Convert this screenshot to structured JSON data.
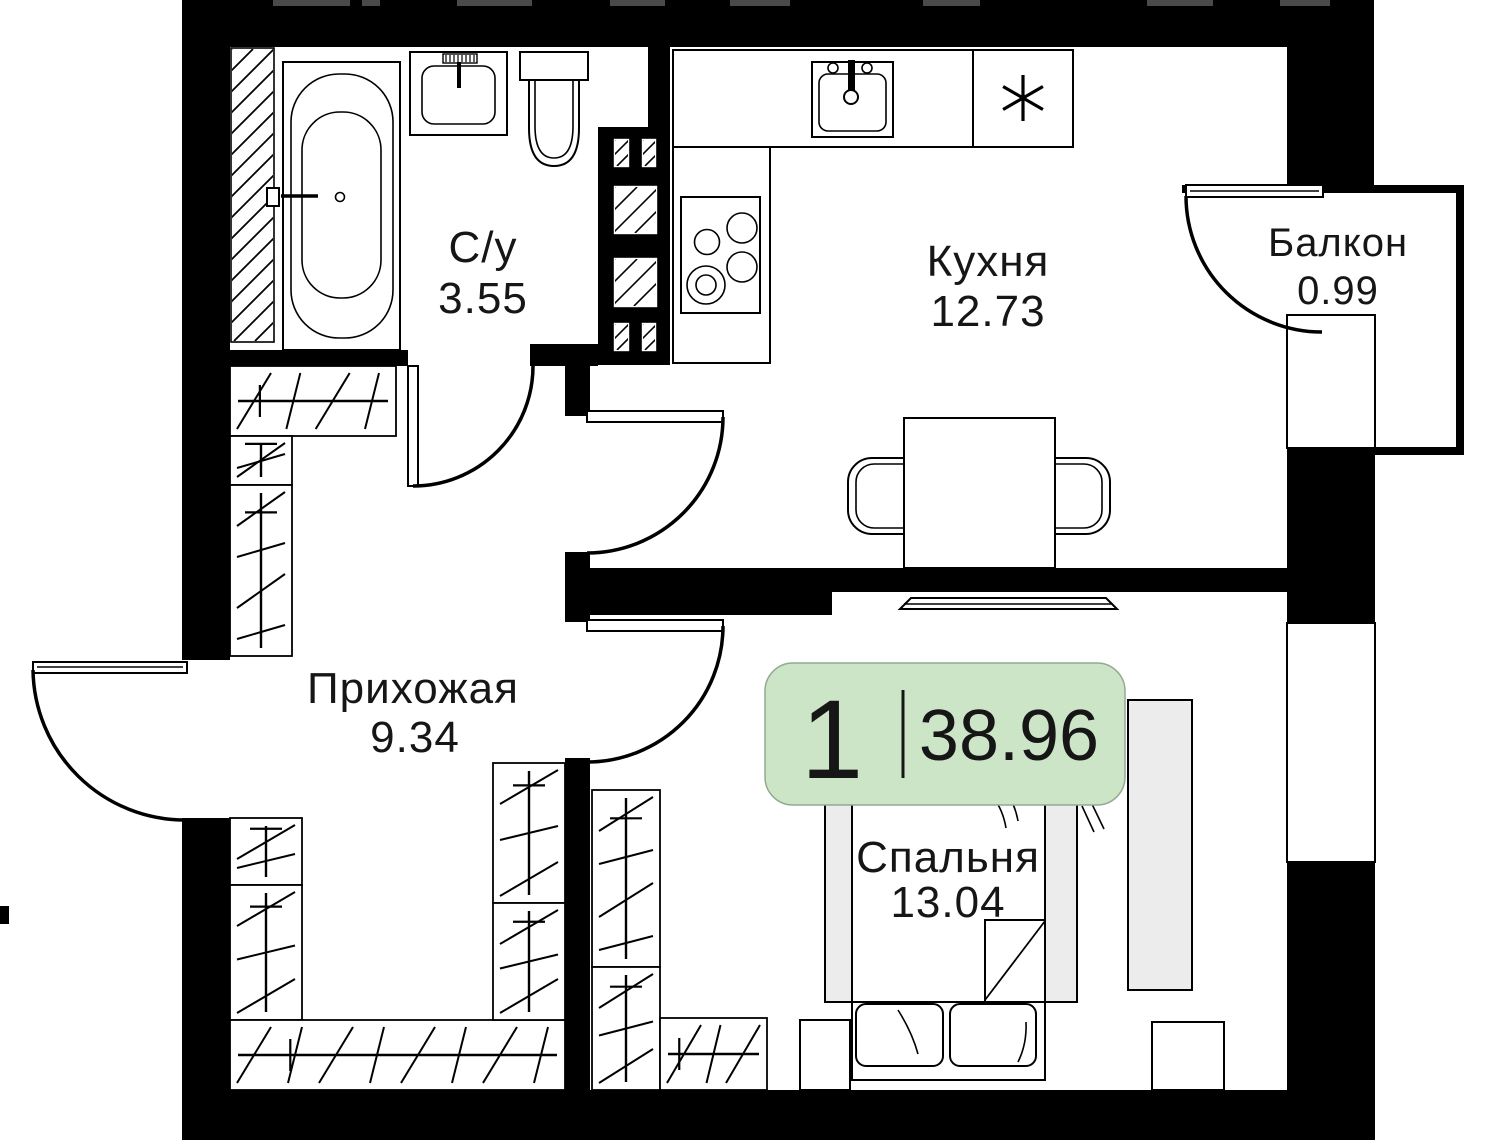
{
  "plan": {
    "badge": {
      "rooms_count": "1",
      "total_area": "38.96"
    },
    "rooms": [
      {
        "name": "С/у",
        "area": "3.55"
      },
      {
        "name": "Кухня",
        "area": "12.73"
      },
      {
        "name": "Балкон",
        "area": "0.99"
      },
      {
        "name": "Прихожая",
        "area": "9.34"
      },
      {
        "name": "Спальня",
        "area": "13.04"
      }
    ]
  },
  "icons": {
    "fridge": "asterisk-icon"
  },
  "colors": {
    "wall": "#000000",
    "badge_fill": "#cde5c7",
    "badge_stroke": "#94a990",
    "furniture_fill": "#ececec",
    "paper": "#ffffff",
    "ink": "#161616"
  }
}
